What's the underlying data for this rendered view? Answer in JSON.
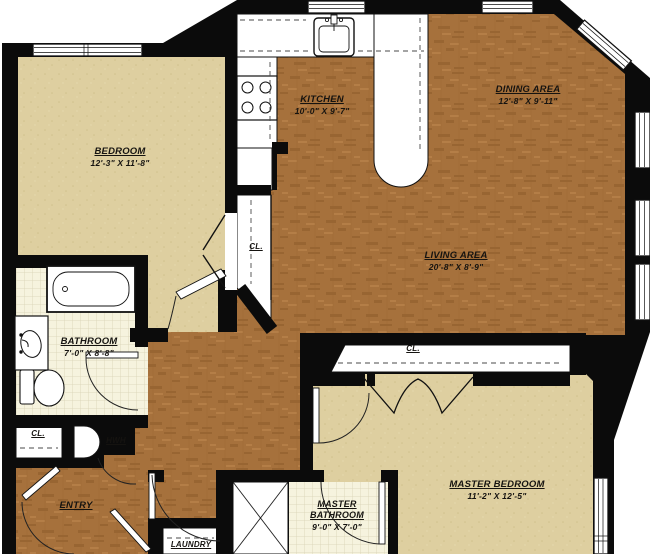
{
  "plan": {
    "rooms": {
      "bedroom": {
        "name": "BEDROOM",
        "dims": "12'-3\" X 11'-8\""
      },
      "kitchen": {
        "name": "KITCHEN",
        "dims": "10'-0\" X 9'-7\""
      },
      "dining": {
        "name": "DINING AREA",
        "dims": "12'-8\" X 9'-11\""
      },
      "living": {
        "name": "LIVING AREA",
        "dims": "20'-8\" X 8'-9\""
      },
      "bathroom": {
        "name": "BATHROOM",
        "dims": "7'-0\" X 8'-8\""
      },
      "master_bedroom": {
        "name": "MASTER BEDROOM",
        "dims": "11'-2\" X 12'-5\""
      },
      "master_bathroom": {
        "name": "MASTER BATHROOM",
        "dims": "9'-0\" X 7'-0\""
      },
      "entry": {
        "name": "ENTRY"
      },
      "laundry": {
        "name": "LAUNDRY"
      }
    },
    "labels": {
      "closet": "CL.",
      "water_heater": "HWH"
    },
    "colors": {
      "wood": "#A6713C",
      "carpet": "#DECFA0",
      "tile": "#F6F3DE",
      "wall": "#0B0B0B",
      "fixture": "#FFFFFF"
    }
  }
}
